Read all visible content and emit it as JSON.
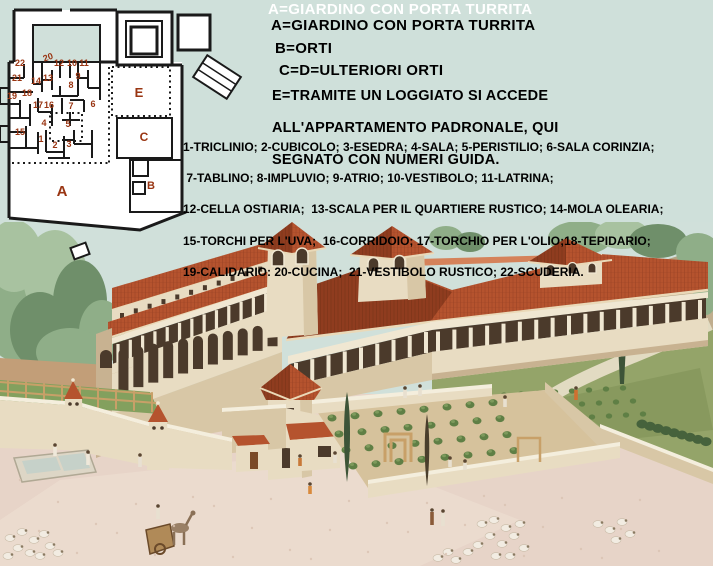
{
  "page": {
    "width": 713,
    "height": 566,
    "background_color": "#cfe0da"
  },
  "legend": {
    "ghost_title": "A=GIARDINO CON PORTA TURRITA",
    "ghost_color": "#ffffff",
    "text_color": "#000000",
    "line_a": "A=GIARDINO CON PORTA TURRITA",
    "line_b": "B=ORTI",
    "line_cd": "C=D=ULTERIORI ORTI",
    "line_e1": "E=TRAMITE UN LOGGIATO SI ACCEDE",
    "line_e2": "ALL'APPARTAMENTO PADRONALE, QUI",
    "line_e3": "SEGNATO CON NUMERI GUIDA."
  },
  "room_list": {
    "text_color": "#000000",
    "line1": "1-TRICLINIO; 2-CUBICOLO; 3-ESEDRA; 4-SALA; 5-PERISTILIO; 6-SALA CORINZIA;",
    "line2": " 7-TABLINO; 8-IMPLUVIO; 9-ATRIO; 10-VESTIBOLO; 11-LATRINA;",
    "line3": "12-CELLA OSTIARIA;  13-SCALA PER IL QUARTIERE RUSTICO; 14-MOLA OLEARIA;",
    "line4": "15-TORCHI PER L'UVA;  16-CORRIDOIO; 17-TORCHIO PER L'OLIO;18-TEPIDARIO;",
    "line5": "19-CALIDARIO: 20-CUCINA;  21-VESTIBOLO RUSTICO; 22-SCUDERIA."
  },
  "plan": {
    "wall_color": "#1a1a1a",
    "paper_color": "#ffffff",
    "label_color": "#993512",
    "letters": [
      {
        "t": "E",
        "x": 139,
        "y": 97,
        "s": 13
      },
      {
        "t": "C",
        "x": 144,
        "y": 141,
        "s": 12
      },
      {
        "t": "B",
        "x": 151,
        "y": 189,
        "s": 11
      },
      {
        "t": "A",
        "x": 62,
        "y": 196,
        "s": 15
      }
    ],
    "numbers": [
      {
        "t": "22",
        "x": 20,
        "y": 66
      },
      {
        "t": "21",
        "x": 17,
        "y": 81
      },
      {
        "t": "19",
        "x": 12,
        "y": 99
      },
      {
        "t": "18",
        "x": 27,
        "y": 96
      },
      {
        "t": "20",
        "x": 49,
        "y": 60,
        "r": -20
      },
      {
        "t": "12",
        "x": 59,
        "y": 66
      },
      {
        "t": "10",
        "x": 72,
        "y": 66
      },
      {
        "t": "11",
        "x": 84,
        "y": 66
      },
      {
        "t": "14",
        "x": 36,
        "y": 84
      },
      {
        "t": "13",
        "x": 48,
        "y": 81
      },
      {
        "t": "9",
        "x": 78,
        "y": 79
      },
      {
        "t": "8",
        "x": 71,
        "y": 88
      },
      {
        "t": "17",
        "x": 38,
        "y": 108
      },
      {
        "t": "16",
        "x": 49,
        "y": 108
      },
      {
        "t": "7",
        "x": 71,
        "y": 109
      },
      {
        "t": "6",
        "x": 93,
        "y": 107
      },
      {
        "t": "5",
        "x": 68,
        "y": 127
      },
      {
        "t": "4",
        "x": 44,
        "y": 126
      },
      {
        "t": "15",
        "x": 20,
        "y": 135
      },
      {
        "t": "1",
        "x": 41,
        "y": 142
      },
      {
        "t": "2",
        "x": 55,
        "y": 148
      },
      {
        "t": "3",
        "x": 69,
        "y": 147
      }
    ]
  },
  "painting": {
    "palette": {
      "sky": "#d0e0da",
      "foliage": "#8fae88",
      "foliage2": "#6f8f6a",
      "foliage3": "#a8c2a0",
      "hill": "#b2a383",
      "hill2": "#c0ae8e",
      "roof": "#b5532e",
      "roofdark": "#8f3c1f",
      "rooflight": "#d5825a",
      "rooftrim": "#ead9b8",
      "wall": "#e8dcc2",
      "wall2": "#d8c7a6",
      "wall3": "#c8b291",
      "wallhi": "#f4eedd",
      "opening": "#4b3a2b",
      "column": "#f0e7d2",
      "lawn": "#94a469",
      "lawndark": "#7d8f55",
      "path": "#e2dbc2",
      "ground": "#e7d4c8",
      "ground2": "#efdfd2",
      "dirt": "#c29e78",
      "soil": "#d6c29c",
      "bush": "#5f7f45",
      "bushdark": "#46623c",
      "water": "#c6d1c9",
      "basinrim": "#ddd6c6",
      "sheep": "#f2ece2",
      "cypress": "#3d5438",
      "wood": "#b08a58",
      "pergola": "#c8a068",
      "skin": "#5a4632"
    }
  }
}
